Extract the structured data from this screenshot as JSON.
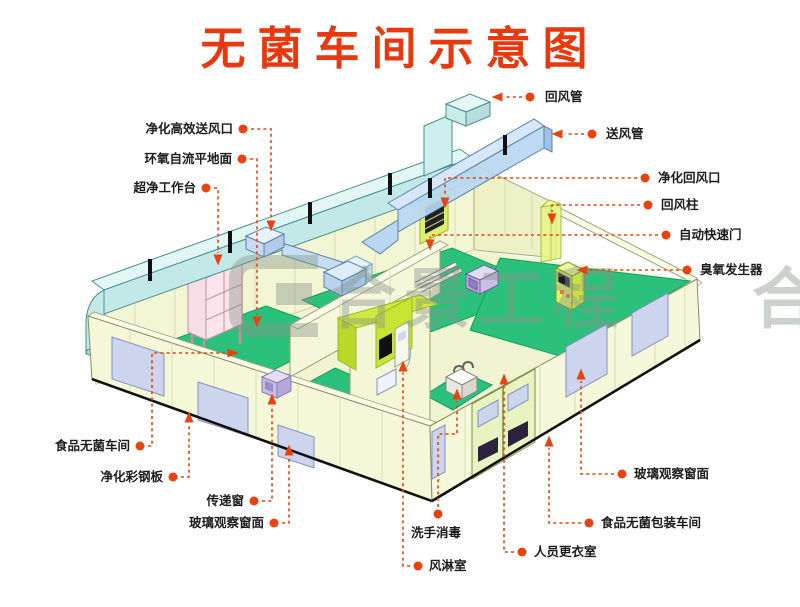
{
  "title": "无菌车间示意图",
  "watermark": {
    "text": "合景工程",
    "edge_text": "合"
  },
  "colors": {
    "title_red": "#e8380e",
    "leader_red": "#e8420e",
    "floor_green": "#2cc07d",
    "shower_chartreuse": "#cfe93f",
    "duct_cyan": "#c2e9e8",
    "duct_blue": "#b9d7f1",
    "wall_cream": "#f4f6d4",
    "window_lavender": "#cdd4ee",
    "bench_pink": "#f7dde6"
  },
  "labels": [
    {
      "id": "return-duct",
      "text": "回风管",
      "align": "left",
      "tx": 545,
      "ty": 101,
      "dot": [
        530,
        97
      ],
      "path": [
        [
          522,
          97
        ],
        [
          505,
          97
        ]
      ],
      "arrow": {
        "x": 497,
        "y": 97,
        "dir": "left"
      }
    },
    {
      "id": "supply-duct",
      "text": "送风管",
      "align": "left",
      "tx": 606,
      "ty": 138,
      "dot": [
        592,
        134
      ],
      "path": [
        [
          584,
          134
        ],
        [
          565,
          134
        ]
      ],
      "arrow": {
        "x": 557,
        "y": 134,
        "dir": "left"
      }
    },
    {
      "id": "purifying-return-vent",
      "text": "净化回风口",
      "align": "left",
      "tx": 658,
      "ty": 182,
      "dot": [
        645,
        178
      ],
      "path": [
        [
          637,
          178
        ],
        [
          445,
          178
        ],
        [
          445,
          196
        ]
      ],
      "arrow": {
        "x": 445,
        "y": 203,
        "dir": "down"
      }
    },
    {
      "id": "return-air-column",
      "text": "回风柱",
      "align": "left",
      "tx": 661,
      "ty": 209,
      "dot": [
        648,
        205
      ],
      "path": [
        [
          640,
          205
        ],
        [
          552,
          205
        ],
        [
          552,
          212
        ]
      ],
      "arrow": {
        "x": 552,
        "y": 219,
        "dir": "down"
      }
    },
    {
      "id": "auto-rapid-door",
      "text": "自动快速门",
      "align": "left",
      "tx": 679,
      "ty": 239,
      "dot": [
        666,
        235
      ],
      "path": [
        [
          658,
          235
        ],
        [
          430,
          235
        ],
        [
          430,
          238
        ]
      ],
      "arrow": {
        "x": 430,
        "y": 245,
        "dir": "down"
      }
    },
    {
      "id": "ozone-generator",
      "text": "臭氧发生器",
      "align": "left",
      "tx": 700,
      "ty": 274,
      "dot": [
        687,
        270
      ],
      "path": [
        [
          679,
          270
        ],
        [
          589,
          270
        ]
      ],
      "arrow": {
        "x": 582,
        "y": 270,
        "dir": "left"
      }
    },
    {
      "id": "glass-window-right",
      "text": "玻璃观察窗面",
      "align": "left",
      "tx": 634,
      "ty": 478,
      "dot": [
        622,
        474
      ],
      "path": [
        [
          614,
          474
        ],
        [
          581,
          474
        ],
        [
          581,
          381
        ]
      ],
      "arrow": {
        "x": 581,
        "y": 374,
        "dir": "up"
      }
    },
    {
      "id": "packing-workshop",
      "text": "食品无菌包装车间",
      "align": "left",
      "tx": 601,
      "ty": 527,
      "dot": [
        589,
        523
      ],
      "path": [
        [
          581,
          523
        ],
        [
          549,
          523
        ],
        [
          549,
          448
        ]
      ],
      "arrow": {
        "x": 549,
        "y": 441,
        "dir": "up"
      }
    },
    {
      "id": "changing-room",
      "text": "人员更衣室",
      "align": "left",
      "tx": 534,
      "ty": 556,
      "dot": [
        522,
        552
      ],
      "path": [
        [
          514,
          552
        ],
        [
          504,
          552
        ],
        [
          504,
          386
        ]
      ],
      "arrow": {
        "x": 504,
        "y": 379,
        "dir": "up"
      }
    },
    {
      "id": "hand-wash",
      "text": "洗手消毒",
      "align": "left",
      "tx": 411,
      "ty": 537,
      "dot": [
        438,
        514
      ],
      "path": [
        [
          438,
          507
        ],
        [
          438,
          434
        ],
        [
          457,
          434
        ],
        [
          457,
          401
        ]
      ],
      "arrow": {
        "x": 457,
        "y": 394,
        "dir": "up"
      }
    },
    {
      "id": "air-shower",
      "text": "风淋室",
      "align": "left",
      "tx": 429,
      "ty": 570,
      "dot": [
        418,
        566
      ],
      "path": [
        [
          410,
          566
        ],
        [
          403,
          566
        ],
        [
          403,
          373
        ]
      ],
      "arrow": {
        "x": 403,
        "y": 366,
        "dir": "up"
      }
    },
    {
      "id": "hepa-supply-vent",
      "text": "净化高效送风口",
      "align": "right",
      "tx": 233,
      "ty": 133,
      "dot": [
        243,
        129
      ],
      "path": [
        [
          251,
          129
        ],
        [
          271,
          129
        ],
        [
          271,
          219
        ]
      ],
      "arrow": {
        "x": 271,
        "y": 226,
        "dir": "down"
      }
    },
    {
      "id": "epoxy-floor",
      "text": "环氧自流平地面",
      "align": "right",
      "tx": 232,
      "ty": 163,
      "dot": [
        242,
        159
      ],
      "path": [
        [
          250,
          159
        ],
        [
          257,
          159
        ],
        [
          257,
          315
        ]
      ],
      "arrow": {
        "x": 257,
        "y": 322,
        "dir": "down"
      }
    },
    {
      "id": "clean-bench",
      "text": "超净工作台",
      "align": "right",
      "tx": 196,
      "ty": 192,
      "dot": [
        206,
        188
      ],
      "path": [
        [
          214,
          188
        ],
        [
          218,
          188
        ],
        [
          218,
          253
        ]
      ],
      "arrow": {
        "x": 218,
        "y": 260,
        "dir": "down"
      }
    },
    {
      "id": "sterile-workshop",
      "text": "食品无菌车间",
      "align": "right",
      "tx": 130,
      "ty": 450,
      "dot": [
        140,
        446
      ],
      "path": [
        [
          148,
          446
        ],
        [
          152,
          446
        ],
        [
          152,
          353
        ],
        [
          226,
          353
        ]
      ],
      "arrow": {
        "x": 233,
        "y": 353,
        "dir": "right"
      }
    },
    {
      "id": "steel-panel",
      "text": "净化彩钢板",
      "align": "right",
      "tx": 163,
      "ty": 481,
      "dot": [
        173,
        477
      ],
      "path": [
        [
          181,
          477
        ],
        [
          189,
          477
        ],
        [
          189,
          424
        ]
      ],
      "arrow": {
        "x": 189,
        "y": 417,
        "dir": "up"
      }
    },
    {
      "id": "transfer-window",
      "text": "传递窗",
      "align": "right",
      "tx": 244,
      "ty": 505,
      "dot": [
        254,
        501
      ],
      "path": [
        [
          262,
          501
        ],
        [
          272,
          501
        ],
        [
          272,
          406
        ]
      ],
      "arrow": {
        "x": 272,
        "y": 399,
        "dir": "up"
      }
    },
    {
      "id": "glass-window-left",
      "text": "玻璃观察窗面",
      "align": "right",
      "tx": 264,
      "ty": 527,
      "dot": [
        274,
        523
      ],
      "path": [
        [
          282,
          523
        ],
        [
          289,
          523
        ],
        [
          289,
          457
        ]
      ],
      "arrow": {
        "x": 289,
        "y": 450,
        "dir": "up"
      }
    }
  ]
}
